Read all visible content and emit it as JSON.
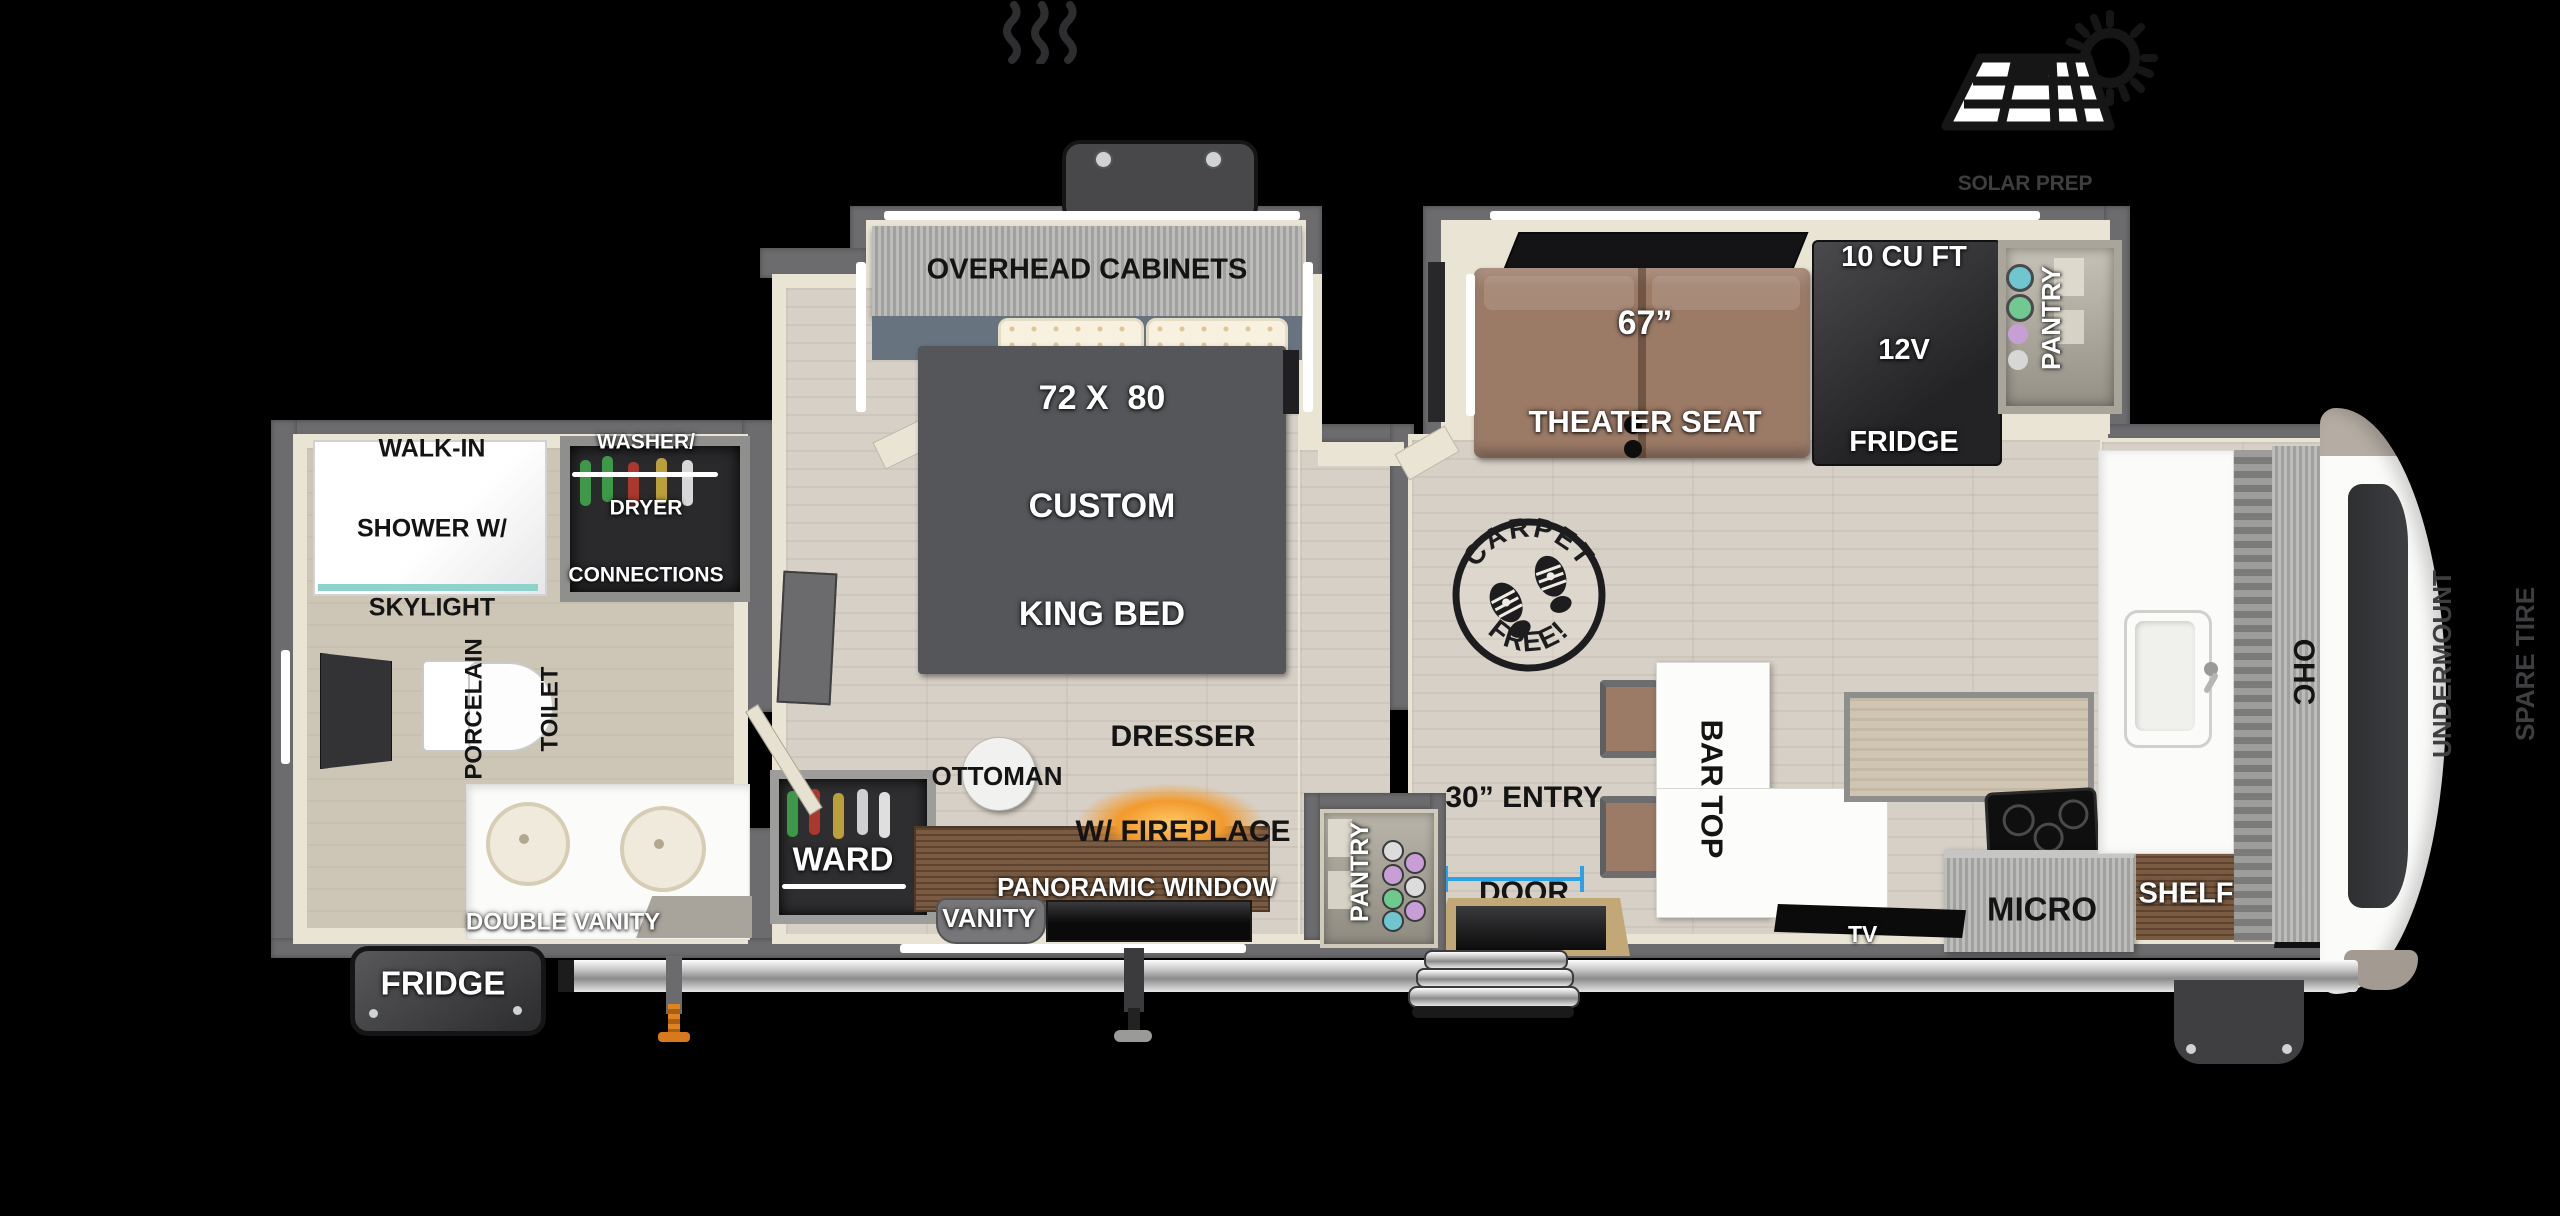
{
  "page": {
    "width": 2560,
    "height": 1216,
    "background": "#000000",
    "type": "rv-floorplan-diagram"
  },
  "colors": {
    "wall_gray": "#6c6c6e",
    "interior_cream": "#eae4d4",
    "wood_floor": "#d7d0c6",
    "bath_floor": "#cdc6b7",
    "bed_gray": "#54565a",
    "seat_brown": "#9b7a66",
    "dresser_wood": "#7a5a40",
    "dimension_blue": "#2da1e8",
    "fireplace_glow": "#f29a2e",
    "stamp_ink": "#1d1d1f",
    "note_gray": "#3e3e40",
    "label_white": "#ffffff",
    "label_black": "#141414"
  },
  "labels": {
    "solar_note": [
      "SOLAR PREP",
      "W/ OPTIONAL 200W",
      "SOLAR PACKAGE"
    ],
    "overhead_cabinets": "OVERHEAD CABINETS",
    "king_bed": [
      "72 X  80",
      "CUSTOM",
      "KING BED"
    ],
    "theater_seat": [
      "67”",
      "THEATER SEAT"
    ],
    "fridge_12v": [
      "10 CU FT",
      "12V",
      "FRIDGE"
    ],
    "pantry_slide": "PANTRY",
    "pantry_entry": "PANTRY",
    "carpet_stamp": [
      "CARPET",
      "FREE!"
    ],
    "entry_door": [
      "30” ENTRY",
      "DOOR"
    ],
    "bar_top": "BAR TOP",
    "tv": "TV",
    "micro": "MICRO",
    "shelf": "SHELF",
    "ohc": "OHC",
    "undermount_spare_tire": [
      "UNDERMOUNT",
      "SPARE TIRE"
    ],
    "walk_in_shower": [
      "WALK-IN",
      "SHOWER W/",
      "SKYLIGHT"
    ],
    "washer_dryer": [
      "WASHER/",
      "DRYER",
      "CONNECTIONS"
    ],
    "porcelain_toilet": [
      "PORCELAIN",
      "TOILET"
    ],
    "double_vanity": "DOUBLE VANITY",
    "exterior_fridge": "FRIDGE",
    "ward": "WARD",
    "ottoman": "OTTOMAN",
    "dresser_fireplace": [
      "DRESSER",
      "W/ FIREPLACE"
    ],
    "panoramic_window": "PANORAMIC WINDOW",
    "vanity": "VANITY"
  },
  "icons": [
    "sun-and-solar-panel-icon",
    "heat-waves-icon",
    "carpet-free-stamp",
    "boot-print-icon"
  ]
}
